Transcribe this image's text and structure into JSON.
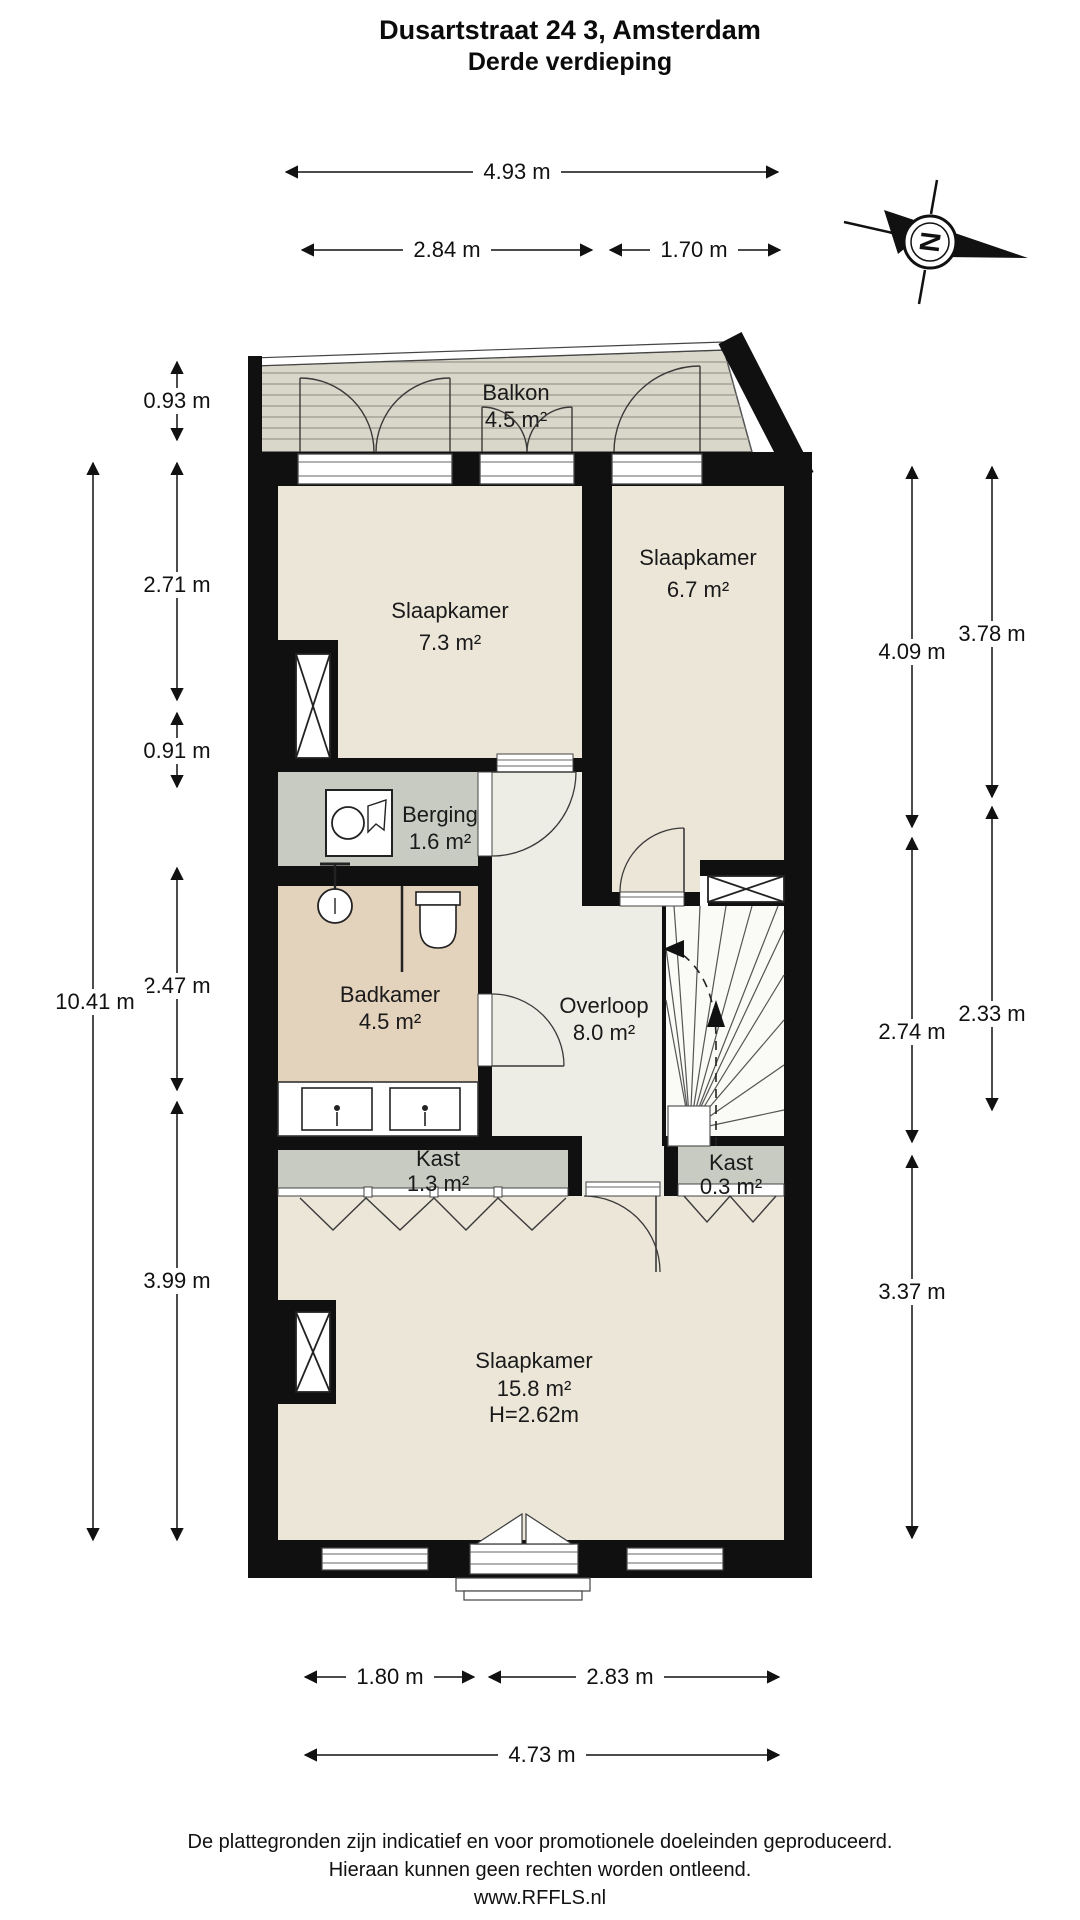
{
  "title": {
    "line1": "Dusartstraat 24 3, Amsterdam",
    "line2": "Derde verdieping"
  },
  "compass": {
    "north_label": "N"
  },
  "rooms": {
    "balkon": {
      "label": "Balkon",
      "area": "4.5 m²"
    },
    "slaapkamer_links": {
      "label": "Slaapkamer",
      "area": "7.3 m²"
    },
    "slaapkamer_rechts": {
      "label": "Slaapkamer",
      "area": "6.7 m²"
    },
    "berging": {
      "label": "Berging",
      "area": "1.6 m²"
    },
    "badkamer": {
      "label": "Badkamer",
      "area": "4.5 m²"
    },
    "overloop": {
      "label": "Overloop",
      "area": "8.0 m²"
    },
    "kast_groot": {
      "label": "Kast",
      "area": "1.3 m²"
    },
    "kast_klein": {
      "label": "Kast",
      "area": "0.3 m²"
    },
    "slaapkamer_groot": {
      "label": "Slaapkamer",
      "area": "15.8 m²",
      "ceiling_height": "H=2.62m"
    }
  },
  "dimensions": {
    "top_total": "4.93 m",
    "top_left": "2.84 m",
    "top_right": "1.70 m",
    "left_balkon": "0.93 m",
    "left_1": "2.71 m",
    "left_2": "0.91 m",
    "left_3": "2.47 m",
    "left_4": "3.99 m",
    "left_total": "10.41 m",
    "right_1": "4.09 m",
    "right_2": "3.78 m",
    "right_3": "2.74 m",
    "right_4": "2.33 m",
    "right_5": "3.37 m",
    "bottom_left": "1.80 m",
    "bottom_right": "2.83 m",
    "bottom_total": "4.73 m"
  },
  "footer": {
    "line1": "De plattegronden zijn indicatief en voor promotionele doeleinden geproduceerd.",
    "line2": "Hieraan kunnen geen rechten worden ontleend.",
    "line3": "www.RFFLS.nl"
  },
  "colors": {
    "wall": "#101010",
    "floor_beige": "#ebe6d8",
    "floor_hall": "#edece5",
    "floor_gray": "#c7cbc2",
    "floor_tan": "#e3d2bc",
    "balcony": "#d9d7c9",
    "balcony_stripe": "#a6a497",
    "line": "#333333"
  }
}
